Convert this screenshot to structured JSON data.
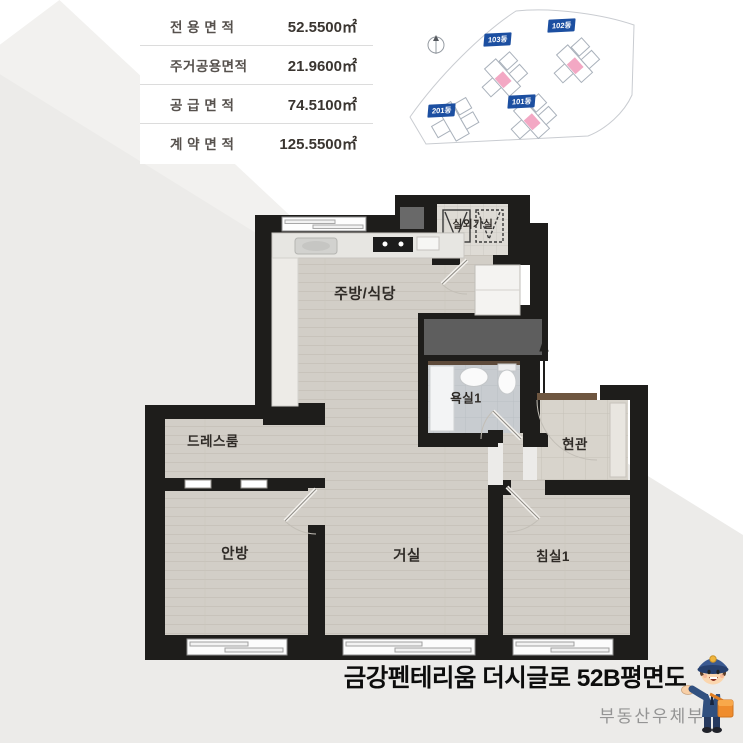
{
  "area_table": {
    "rows": [
      {
        "label": "전 용 면 적",
        "value": "52.5500㎡"
      },
      {
        "label": "주거공용면적",
        "value": "21.9600㎡"
      },
      {
        "label": "공 급 면 적",
        "value": "74.5100㎡"
      },
      {
        "label": "계 약 면 적",
        "value": "125.5500㎡"
      }
    ]
  },
  "site_plan": {
    "buildings": [
      {
        "label": "103동"
      },
      {
        "label": "102동"
      },
      {
        "label": "201동"
      },
      {
        "label": "101동"
      }
    ]
  },
  "floor_plan": {
    "rooms": {
      "outdoor_unit": "실외기실",
      "kitchen": "주방/식당",
      "bathroom": "욕실1",
      "entrance": "현관",
      "dressroom": "드레스룸",
      "master": "안방",
      "living": "거실",
      "bedroom1": "침실1"
    }
  },
  "footer": {
    "title": "금강펜테리움 더시글로 52B평면도",
    "watermark": "부동산우체부"
  },
  "colors": {
    "wall": "#1e1d1b",
    "wood_floor": "#d2cec7",
    "bath_tile": "#c8ccd0",
    "entrance_tile": "#d8d4cc",
    "label_blue": "#1c4fa1",
    "highlight_pink": "#f3a8c4",
    "background_gray": "#ecebe9"
  }
}
